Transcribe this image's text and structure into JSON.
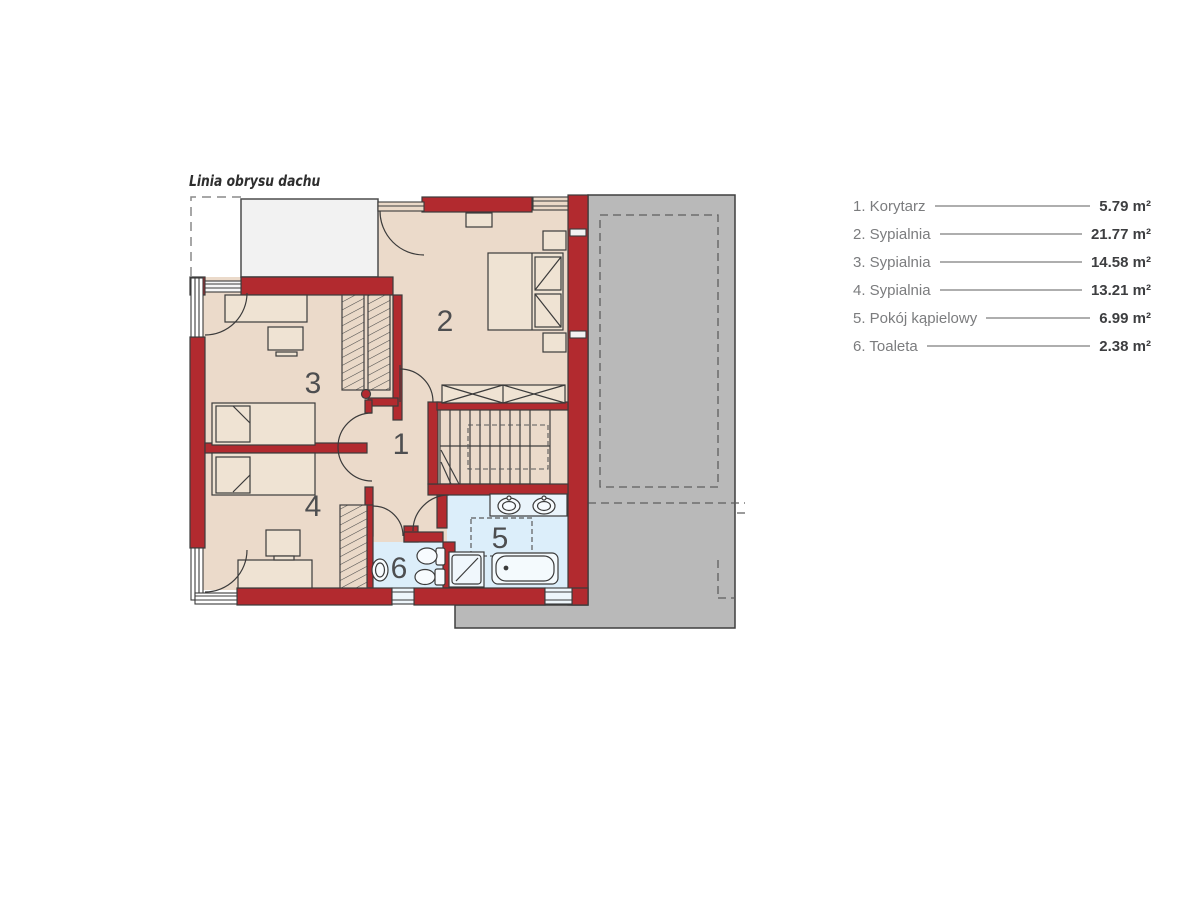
{
  "header": {
    "roof_outline_label": "Linia obrysu dachu"
  },
  "rooms": [
    {
      "number": "1",
      "name": "Korytarz",
      "area": "5.79 m²"
    },
    {
      "number": "2",
      "name": "Sypialnia",
      "area": "21.77 m²"
    },
    {
      "number": "3",
      "name": "Sypialnia",
      "area": "14.58 m²"
    },
    {
      "number": "4",
      "name": "Sypialnia",
      "area": "13.21 m²"
    },
    {
      "number": "5",
      "name": "Pokój kąpielowy",
      "area": "6.99 m²"
    },
    {
      "number": "6",
      "name": "Toaleta",
      "area": "2.38 m²"
    }
  ],
  "legend": {
    "rows": [
      {
        "label": "1. Korytarz",
        "value": "5.79 m²"
      },
      {
        "label": "2. Sypialnia",
        "value": "21.77 m²"
      },
      {
        "label": "3. Sypialnia",
        "value": "14.58 m²"
      },
      {
        "label": "4. Sypialnia",
        "value": "13.21 m²"
      },
      {
        "label": "5. Pokój kąpielowy",
        "value": "6.99 m²"
      },
      {
        "label": "6. Toaleta",
        "value": "2.38 m²"
      }
    ]
  },
  "colors": {
    "wall_red": "#b22a2f",
    "floor_beige": "#ebdaca",
    "wet_floor_blue": "#dceefa",
    "roof_gray": "#b9b9b9",
    "balcony_gray": "#f2f2f2",
    "line_dark": "#3b3b3b",
    "legend_label_gray": "#7b7c7e",
    "legend_value_dark": "#3d3e40"
  }
}
